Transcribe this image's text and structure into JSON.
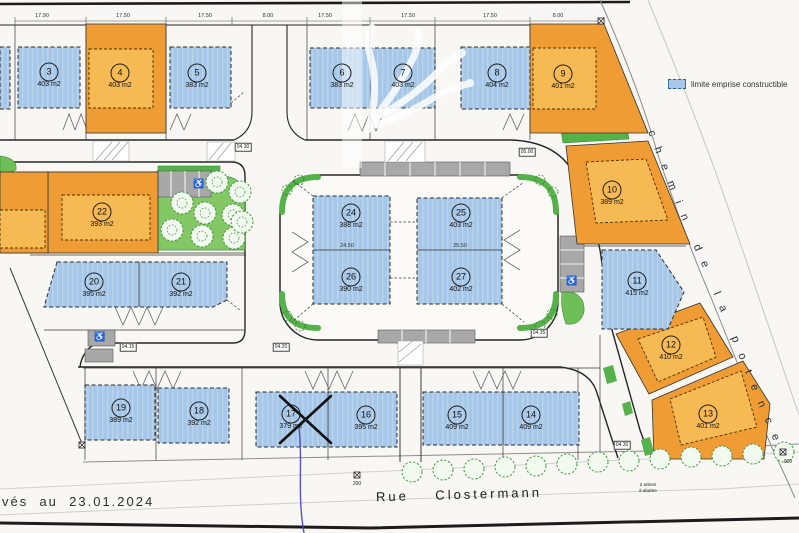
{
  "legend": {
    "label": "limite emprise constructible"
  },
  "streets": {
    "chemin": "chemin de la potence",
    "rue": "Rue    Clostermann"
  },
  "tree_note": {
    "line1": "2 arbres",
    "line2": "à abattre"
  },
  "notes": {
    "date": "vés  au  23.01.2024"
  },
  "colors": {
    "emprise_blue": "#a6c7e7",
    "parcel_orange": "#f09c35",
    "emprise_orange": "#f6ba55",
    "park_green": "#84c765",
    "hedge_green": "#55b24a",
    "parking_grey": "#a8a8a8",
    "line_dark": "#222222",
    "stream_blue": "#4540c0"
  },
  "lots": [
    {
      "num": "3",
      "area": "403 m2",
      "type": "blue",
      "x": 49,
      "y": 72
    },
    {
      "num": "4",
      "area": "403 m2",
      "type": "orange",
      "x": 120,
      "y": 73
    },
    {
      "num": "5",
      "area": "383 m2",
      "type": "blue",
      "x": 197,
      "y": 73
    },
    {
      "num": "6",
      "area": "383 m2",
      "type": "blue",
      "x": 342,
      "y": 73
    },
    {
      "num": "7",
      "area": "403 m2",
      "type": "blue",
      "x": 403,
      "y": 73
    },
    {
      "num": "8",
      "area": "404 m2",
      "type": "blue",
      "x": 497,
      "y": 73
    },
    {
      "num": "9",
      "area": "401 m2",
      "type": "orange",
      "x": 563,
      "y": 74
    },
    {
      "num": "10",
      "area": "389 m2",
      "type": "orange",
      "x": 612,
      "y": 190
    },
    {
      "num": "11",
      "area": "415 m2",
      "type": "blue",
      "x": 637,
      "y": 281
    },
    {
      "num": "12",
      "area": "410 m2",
      "type": "orange",
      "x": 671,
      "y": 345
    },
    {
      "num": "13",
      "area": "401 m2",
      "type": "orange",
      "x": 708,
      "y": 414
    },
    {
      "num": "14",
      "area": "409 m2",
      "type": "blue",
      "x": 531,
      "y": 415
    },
    {
      "num": "15",
      "area": "409 m2",
      "type": "blue",
      "x": 457,
      "y": 415
    },
    {
      "num": "16",
      "area": "395 m2",
      "type": "blue",
      "x": 366,
      "y": 415
    },
    {
      "num": "17",
      "area": "379 m2",
      "type": "blue",
      "x": 291,
      "y": 414
    },
    {
      "num": "18",
      "area": "392 m2",
      "type": "blue",
      "x": 199,
      "y": 411
    },
    {
      "num": "19",
      "area": "389 m2",
      "type": "blue",
      "x": 121,
      "y": 408
    },
    {
      "num": "20",
      "area": "395 m2",
      "type": "blue",
      "x": 94,
      "y": 282
    },
    {
      "num": "21",
      "area": "392 m2",
      "type": "blue",
      "x": 181,
      "y": 282
    },
    {
      "num": "22",
      "area": "393 m2",
      "type": "orange",
      "x": 102,
      "y": 212
    },
    {
      "num": "24",
      "area": "388 m2",
      "type": "blue",
      "x": 351,
      "y": 213
    },
    {
      "num": "25",
      "area": "403 m2",
      "type": "blue",
      "x": 461,
      "y": 213
    },
    {
      "num": "26",
      "area": "390 m2",
      "type": "blue",
      "x": 351,
      "y": 277
    },
    {
      "num": "27",
      "area": "402 m2",
      "type": "blue",
      "x": 461,
      "y": 277
    }
  ],
  "dimensions": [
    {
      "text": "17.90",
      "x": 42,
      "y": 16
    },
    {
      "text": "17.50",
      "x": 123,
      "y": 16
    },
    {
      "text": "17.50",
      "x": 205,
      "y": 16
    },
    {
      "text": "8.00",
      "x": 268,
      "y": 16
    },
    {
      "text": "17.50",
      "x": 325,
      "y": 16
    },
    {
      "text": "17.50",
      "x": 408,
      "y": 16
    },
    {
      "text": "17.50",
      "x": 490,
      "y": 16
    },
    {
      "text": "8.00",
      "x": 558,
      "y": 16
    },
    {
      "text": "24.50",
      "x": 347,
      "y": 246
    },
    {
      "text": "25.50",
      "x": 460,
      "y": 246
    }
  ],
  "markers": [
    {
      "text": "04.30",
      "x": 243,
      "y": 147
    },
    {
      "text": "05.00",
      "x": 527,
      "y": 152
    },
    {
      "text": "04.15",
      "x": 128,
      "y": 347
    },
    {
      "text": "04.20",
      "x": 281,
      "y": 347
    },
    {
      "text": "04.35",
      "x": 539,
      "y": 333
    },
    {
      "text": "04.30",
      "x": 622,
      "y": 445
    },
    {
      "text": "900",
      "x": 788,
      "y": 462
    },
    {
      "text": "200",
      "x": 357,
      "y": 484
    }
  ]
}
